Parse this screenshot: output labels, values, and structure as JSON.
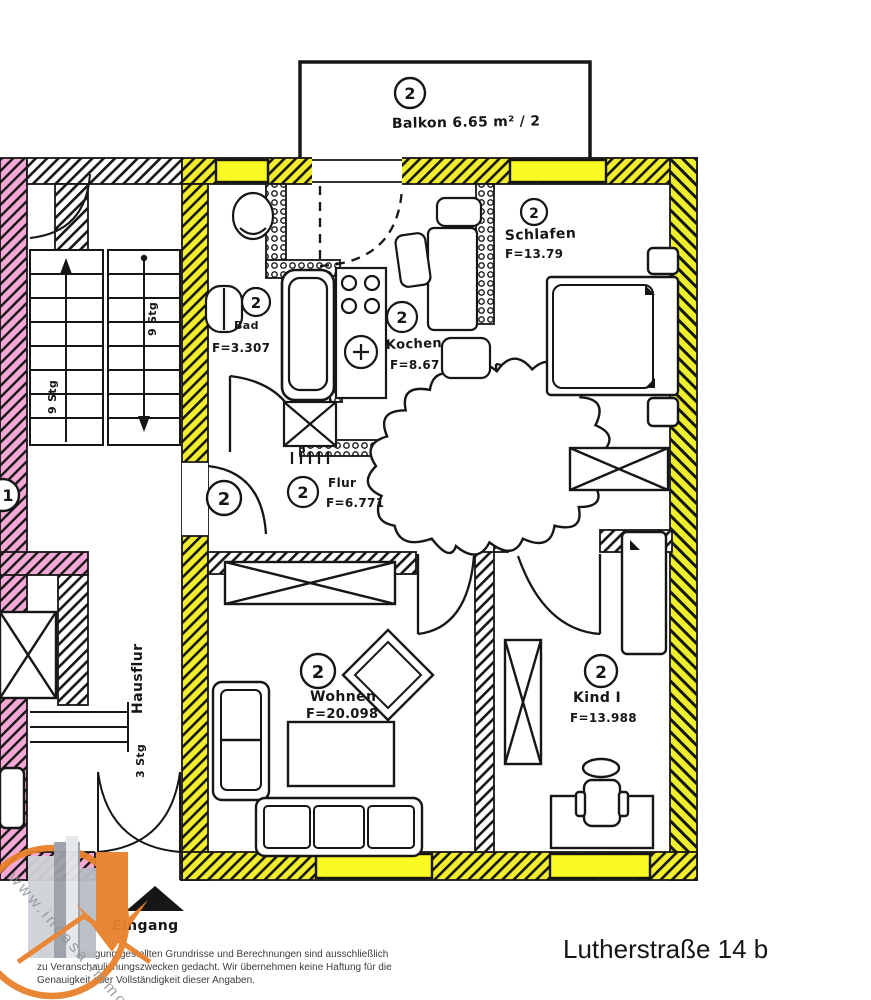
{
  "page": {
    "address": "Lutherstraße 14 b",
    "watermark": "www.incasa.immo",
    "disclaimer": {
      "line1": "Die zur Verfügung gestellten Grundrisse und Berechnungen sind ausschließlich",
      "line2": "zu Veranschaulichungszwecken gedacht. Wir übernehmen keine Haftung für die",
      "line3": "Genauigkeit oder Vollständigkeit dieser Angaben."
    }
  },
  "plan": {
    "unit_number": "2",
    "neighbor_unit_number": "1",
    "balcony_label": "Balkon 6.65 m² / 2",
    "rooms": {
      "bad": {
        "name": "Bad",
        "area": "F=3.307"
      },
      "kochen": {
        "name": "Kochen",
        "area": "F=8.67"
      },
      "schlafen": {
        "name": "Schlafen",
        "area": "F=13.79"
      },
      "flur": {
        "name": "Flur",
        "area": "F=6.771"
      },
      "wohnen": {
        "name": "Wohnen",
        "area": "F=20.098"
      },
      "kind": {
        "name": "Kind I",
        "area": "F=13.988"
      }
    },
    "hausflur_label": "Hausflur",
    "eingang_label": "Eingang",
    "dimensions": {
      "stair_upper": "9 Stg",
      "stair_lower": "9 Stg",
      "hall": "3 Stg"
    }
  },
  "colors": {
    "wall_highlight": "#f2ee2e",
    "window_highlight": "#fbfb24",
    "neighbor_highlight": "#f4a8d6",
    "logo_orange": "#e8812c",
    "ink": "#161616"
  }
}
